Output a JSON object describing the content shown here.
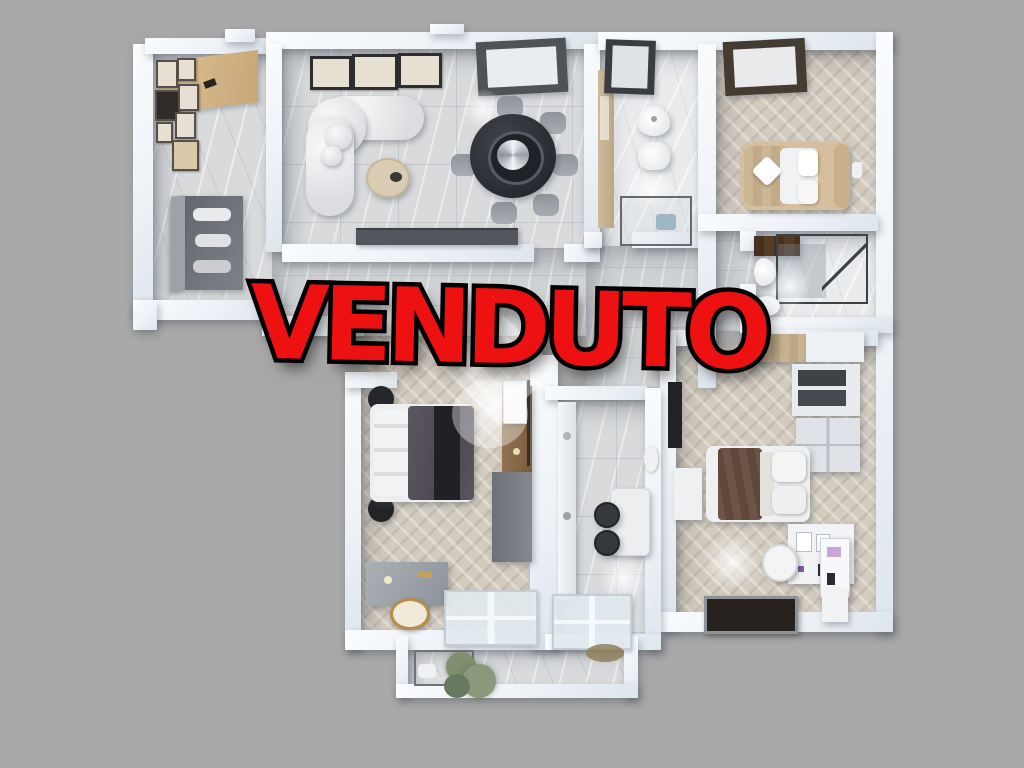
{
  "overlay": {
    "sold_label": "VENDUTO",
    "fill": "#ee1111",
    "outline": "#000000"
  },
  "palette": {
    "background": "#a8a8a9",
    "wall_light": "#fafcfe",
    "wall_mid": "#edf2f7",
    "wall_dark": "#dde5ed",
    "marble": "#d8dadc",
    "marble_bright": "#e9ebed",
    "corridor": "#cfd2d4",
    "herringbone": "#d3cbbe",
    "wood_closet": "#cfab79",
    "sofa_white": "#eef0f2",
    "dining_table_dark": "#2e3136",
    "chair_gray": "#969ba1",
    "sideboard_gray": "#53575d",
    "bed_beige": "#d5bf9e",
    "duvet_gray": "#5b5660",
    "runner_black": "#202125",
    "blanket_brown": "#6e5444",
    "cabinet_gray": "#70757c",
    "wood_console": "#8a6a4e",
    "dark_window": "#27221d",
    "plant_green": "#7f8f6f",
    "vanity_tan": "#cdbb9b"
  }
}
